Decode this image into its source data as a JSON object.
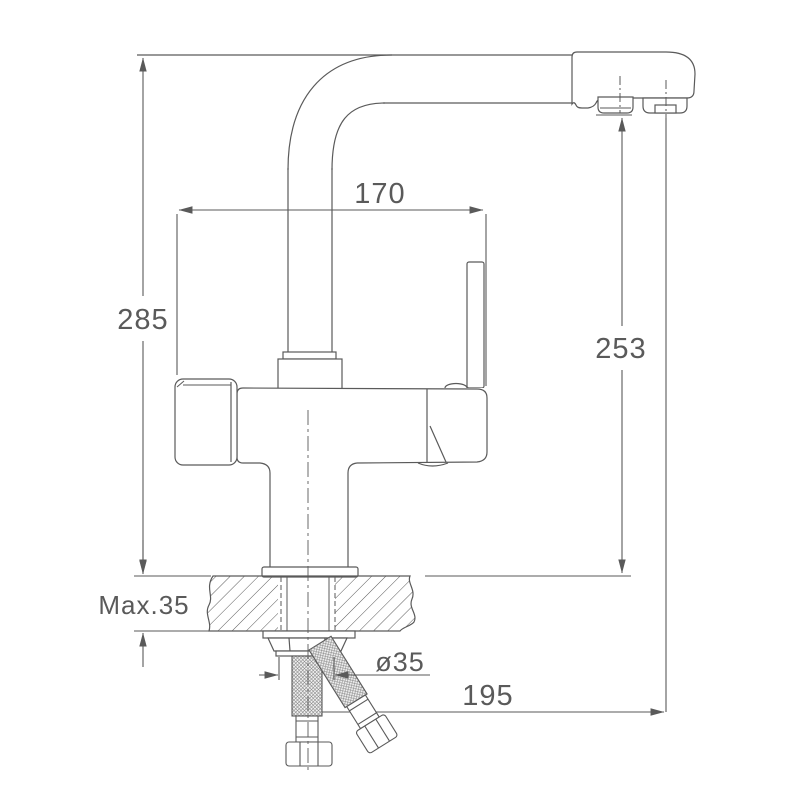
{
  "meta": {
    "drawing_type": "technical-dimension-drawing",
    "subject": "kitchen mixer faucet with filtered-water outlet, side view with counter cross-section",
    "units": "mm"
  },
  "style": {
    "line_color": "#5a5a5a",
    "background": "#ffffff"
  },
  "labels": {
    "spout_width": "170",
    "overall_height": "285",
    "outlet_height": "253",
    "max_counter_thickness": "Max.35",
    "hole_diameter": "ø35",
    "spout_reach": "195"
  }
}
